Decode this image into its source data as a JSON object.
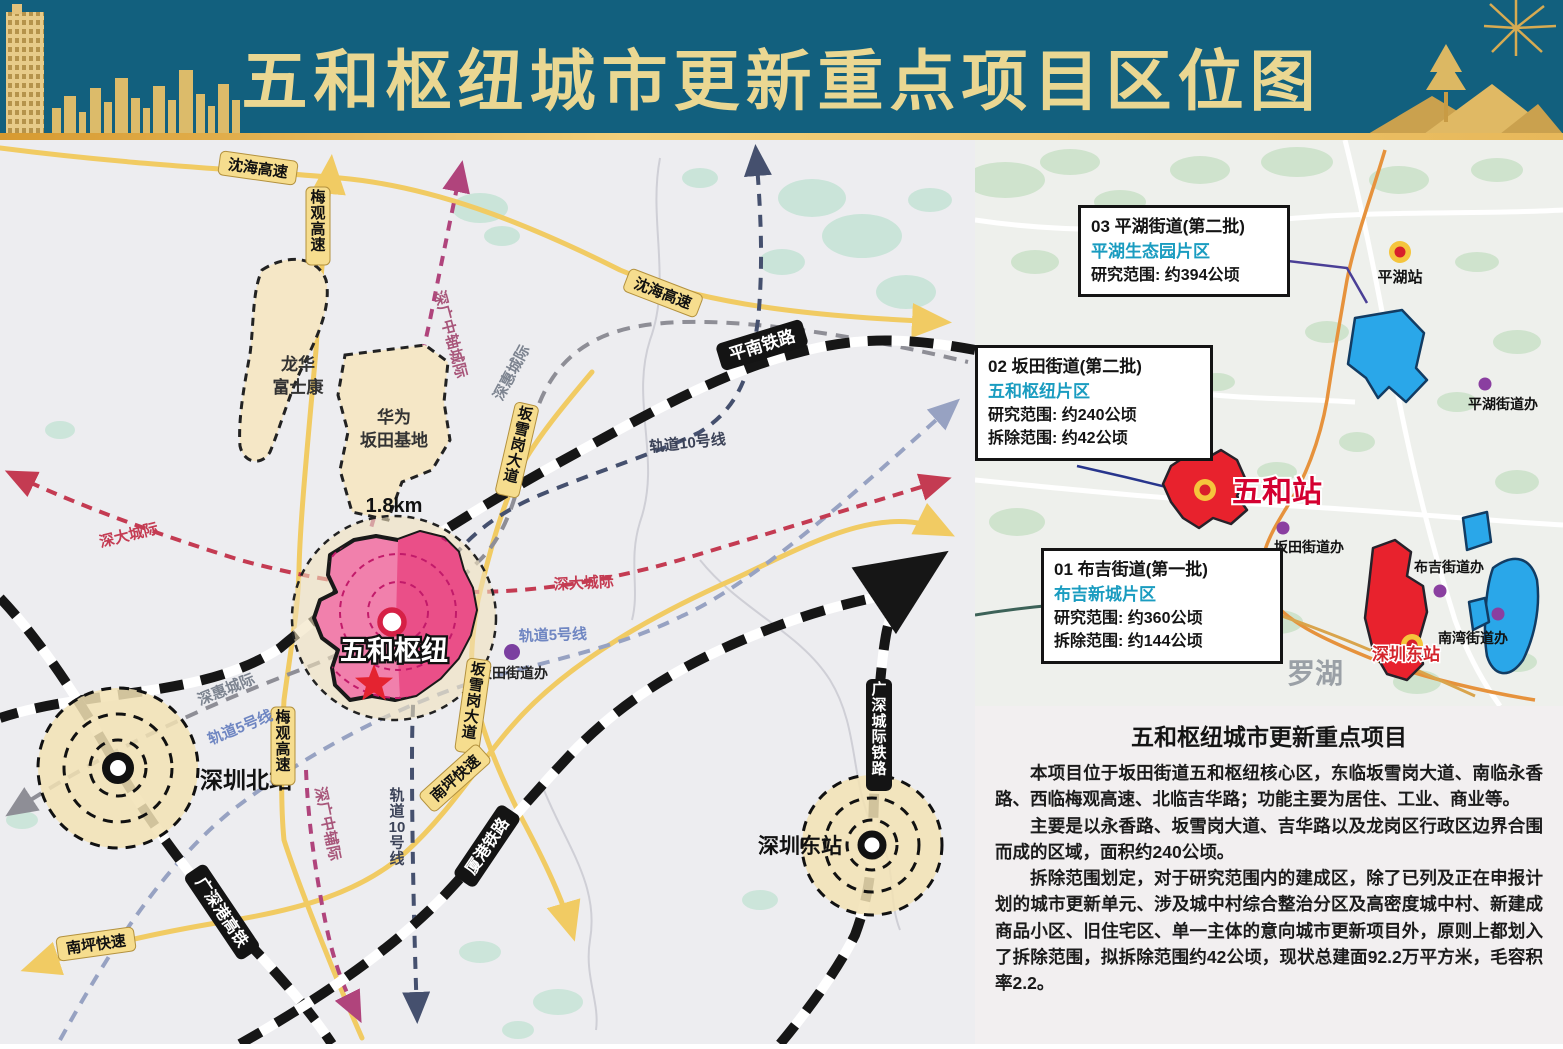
{
  "banner": {
    "title": "五和枢纽城市更新重点项目区位图"
  },
  "colors": {
    "banner_bg": "#12607e",
    "banner_text": "#ead792",
    "road_yellow": "#f1cb63",
    "railway_black": "#161616",
    "shenda_red": "#c43b52",
    "line5_blue": "#97a2c2",
    "line10_navy": "#45506e",
    "shenhui_gray": "#8e8e96",
    "zhongzhou_pink": "#a8567a",
    "hub_pink": "#f180ac",
    "hub_inner": "#ea4f88",
    "region_blue": "#2aa7e9",
    "region_red": "#e8222d",
    "subtitle_teal": "#1a9cc0",
    "boundary_orange": "#e6923c"
  },
  "main_map": {
    "roads": {
      "shenhai": "沈海高速",
      "meiguan": "梅观高速",
      "banxuegang": "坂雪岗大道",
      "nanping": "南坪快速"
    },
    "railways": {
      "pingnan": "平南铁路",
      "xiagang": "厦港铁路",
      "guangshengang": "广深港高铁",
      "guangshen_intercity": "广深城际铁路"
    },
    "lines": {
      "shenhui": "深惠城际",
      "rail5": "轨道5号线",
      "rail10": "轨道10号线",
      "shenda": "深大城际",
      "zhongzhou_n": "深广中轴城际",
      "zhongzhou_s": "深广中辅际"
    },
    "stations": {
      "wuhe_hub": "五和枢纽",
      "shenzhen_north": "深圳北站",
      "shenzhen_east": "深圳东站",
      "radius_label": "1.8km"
    },
    "areas": {
      "longhua_l1": "龙华",
      "longhua_l2": "富士康",
      "huawei_l1": "华为",
      "huawei_l2": "坂田基地"
    },
    "poi": {
      "bantian_office": "坂田街道办"
    }
  },
  "inset": {
    "callouts": [
      {
        "title": "01 布吉街道(第一批)",
        "subtitle": "布吉新城片区",
        "line1": "研究范围: 约360公顷",
        "line2": "拆除范围: 约144公顷"
      },
      {
        "title": "02 坂田街道(第二批)",
        "subtitle": "五和枢纽片区",
        "line1": "研究范围: 约240公顷",
        "line2": "拆除范围: 约42公顷"
      },
      {
        "title": "03 平湖街道(第二批)",
        "subtitle": "平湖生态园片区",
        "line1": "研究范围: 约394公顷"
      }
    ],
    "stations": {
      "pinghu": "平湖站",
      "wuhe": "五和站",
      "shenzhen_east": "深圳东站"
    },
    "offices": {
      "pinghu": "平湖街道办",
      "bantian": "坂田街道办",
      "buji": "布吉街道办",
      "nanwan": "南湾街道办"
    },
    "district_label": "罗湖"
  },
  "panel": {
    "title": "五和枢纽城市更新重点项目",
    "p1": "本项目位于坂田街道五和枢纽核心区，东临坂雪岗大道、南临永香路、西临梅观高速、北临吉华路；功能主要为居住、工业、商业等。",
    "p2": "主要是以永香路、坂雪岗大道、吉华路以及龙岗区行政区边界合围而成的区域，面积约240公顷。",
    "p3": "拆除范围划定，对于研究范围内的建成区，除了已列及正在申报计划的城市更新单元、涉及城中村综合整治分区及高密度城中村、新建成商品小区、旧住宅区、单一主体的意向城市更新项目外，原则上都划入了拆除范围，拟拆除范围约42公顷，现状总建面92.2万平方米，毛容积率2.2。"
  }
}
